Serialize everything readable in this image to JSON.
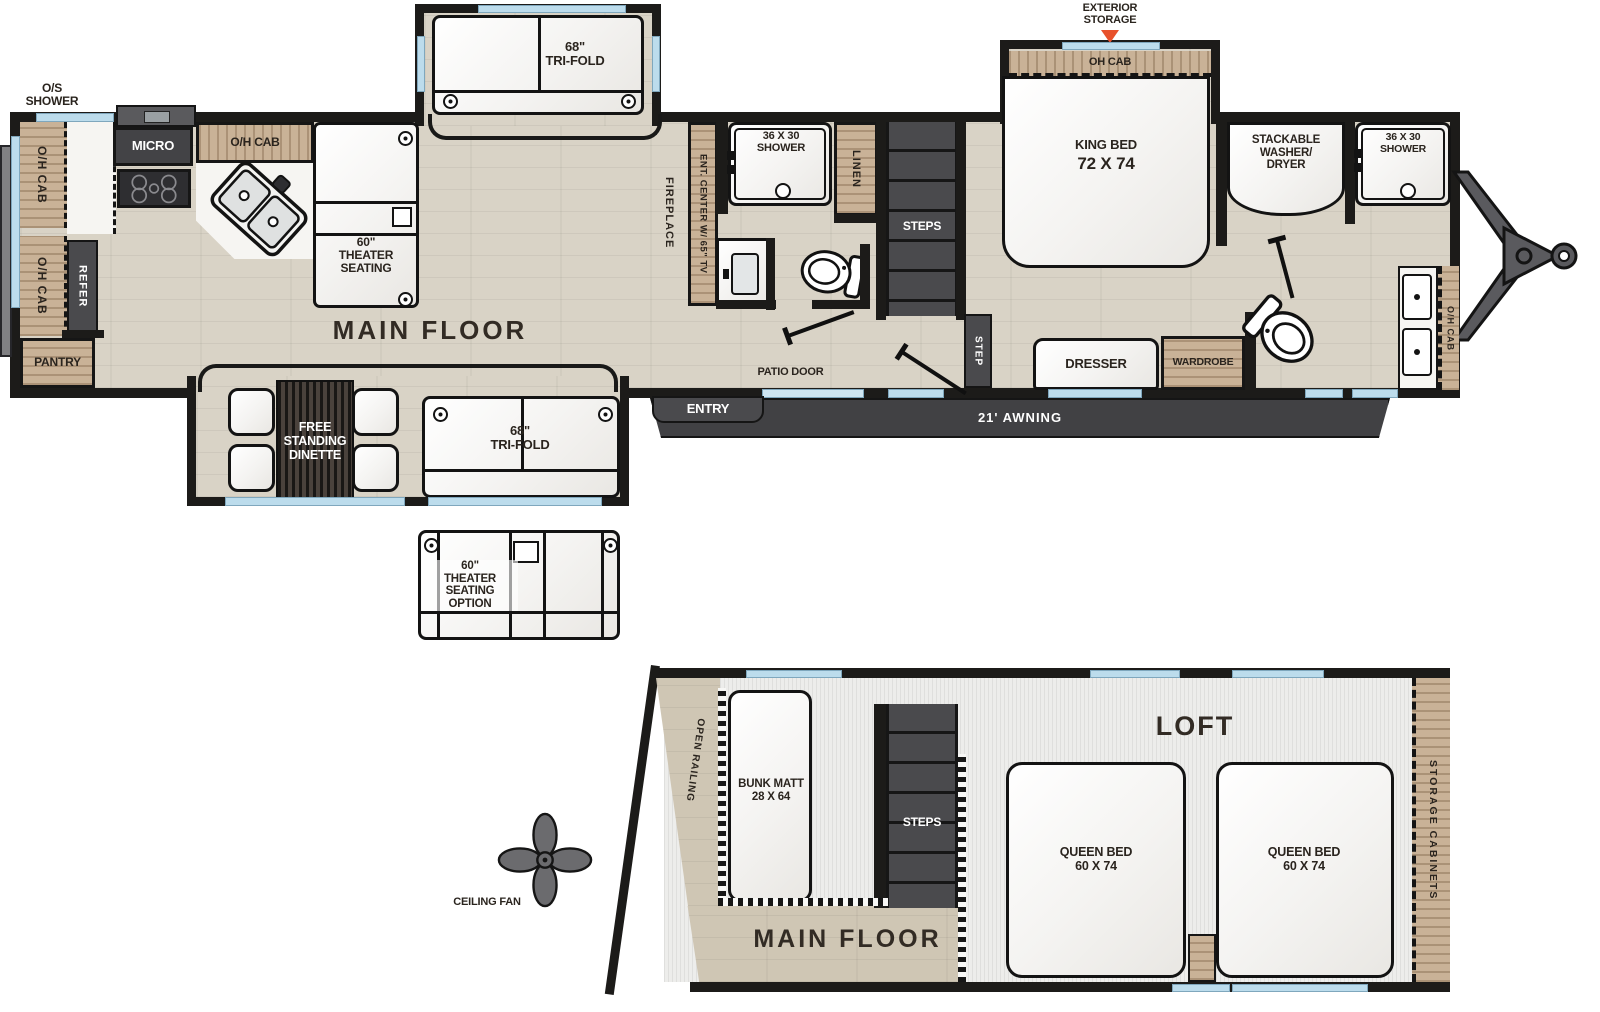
{
  "colors": {
    "wall": "#1c1b19",
    "floor_wood": "#d9d3c6",
    "cabinet_wood": "#c9b297",
    "dark_fixture": "#4a4a4d",
    "window_blue": "#bcdcec",
    "awning_gray": "#414144",
    "arrow_orange": "#e8512b"
  },
  "main_floor": {
    "label": "MAIN FLOOR",
    "exterior": {
      "os_shower": "O/S\nSHOWER",
      "exterior_storage": "EXTERIOR\nSTORAGE",
      "awning": "21' AWNING",
      "entry": "ENTRY",
      "patio_door": "PATIO DOOR"
    },
    "kitchen": {
      "oh_cab": "O/H CAB",
      "micro": "MICRO",
      "refer": "REFER",
      "pantry": "PANTRY"
    },
    "living": {
      "theater_seating": "60\"\nTHEATER\nSEATING",
      "tri_fold": "68\"\nTRI-FOLD",
      "fireplace": "FIREPLACE",
      "ent_center": "ENT. CENTER W/ 65\" TV"
    },
    "mid_bath": {
      "shower": "36 X 30\nSHOWER",
      "linen": "LINEN",
      "steps": "STEPS"
    },
    "bedroom": {
      "king_bed": "KING BED",
      "king_bed_size": "72 X 74",
      "oh_cab": "OH CAB",
      "dresser": "DRESSER",
      "wardrobe": "WARDROBE",
      "step": "STEP"
    },
    "front_bath": {
      "washer_dryer": "STACKABLE\nWASHER/\nDRYER",
      "shower": "36 X 30\nSHOWER",
      "oh_cab": "O/H CAB"
    }
  },
  "bottom_slide": {
    "dinette": "FREE\nSTANDING\nDINETTE",
    "tri_fold": "68\"\nTRI-FOLD"
  },
  "options": {
    "theater_option": "60\"\nTHEATER\nSEATING\nOPTION",
    "ceiling_fan": "CEILING FAN"
  },
  "loft": {
    "label": "LOFT",
    "main_floor": "MAIN FLOOR",
    "open_railing": "OPEN RAILING",
    "bunk_matt": "BUNK MATT\n28 X 64",
    "steps": "STEPS",
    "queen_bed": "QUEEN BED\n60 X 74",
    "storage_cabinets": "STORAGE CABINETS"
  }
}
